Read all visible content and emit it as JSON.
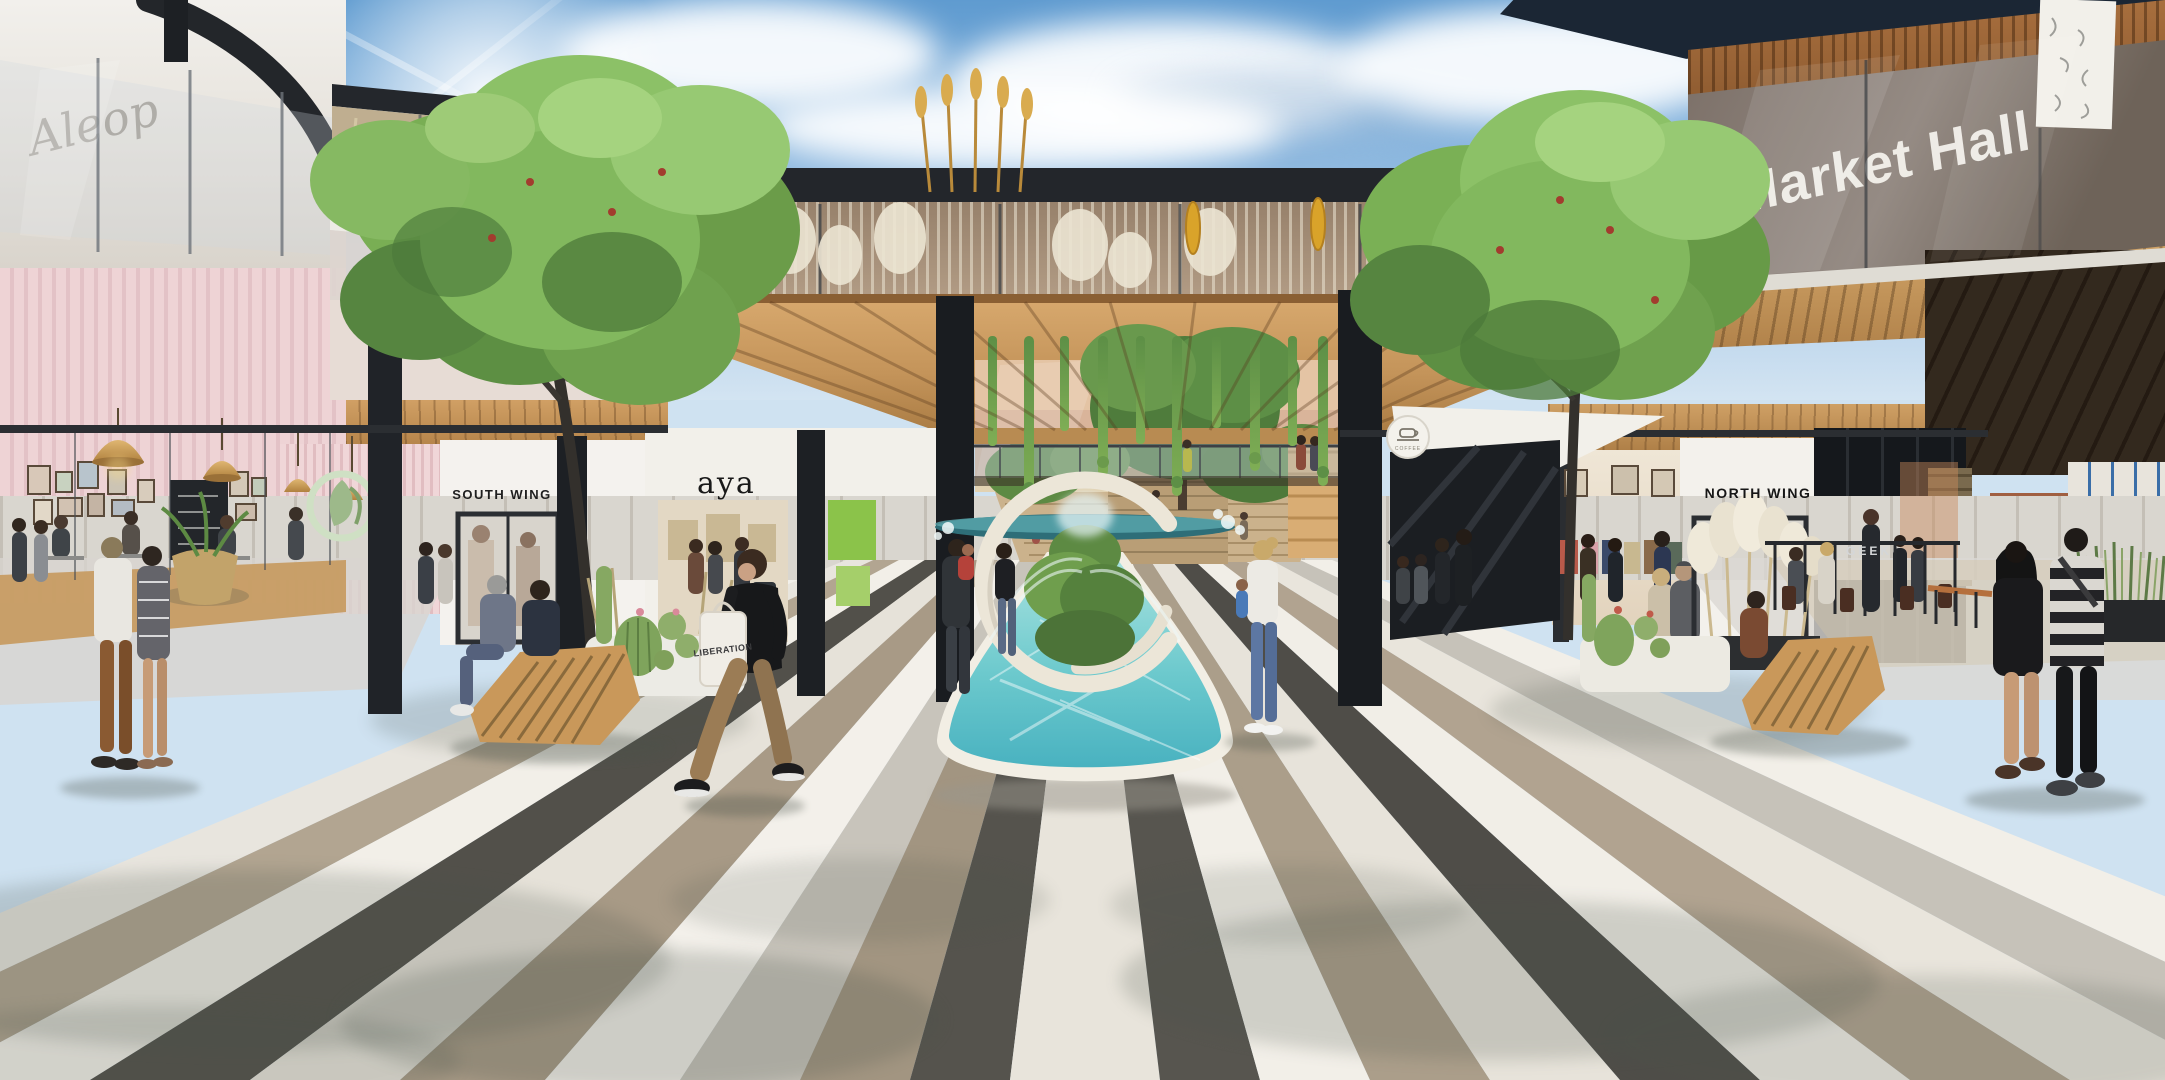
{
  "signs": {
    "aleop": "Aleop",
    "market_hall": "Market Hall",
    "south_wing": "SOUTH WING",
    "aya": "aya",
    "north_wing": "NORTH WING",
    "geek": "GEEK",
    "coffee_sign": "COFFEE",
    "tote_bag": "LIBERATION"
  },
  "icons": {
    "coffee_cup": "coffee-cup-icon",
    "leaf_logo": "leaf-logo-icon",
    "doodle_mural": "doodle-mural-banner"
  },
  "palette": {
    "sky_top": "#5f9bd0",
    "sky_horizon": "#d3e4f2",
    "cloud": "#f4f8fb",
    "wood_canopy": "#c9985f",
    "wood_dark": "#8a6236",
    "structure_dark": "#24272b",
    "glass": "#aebcc8",
    "water": "#59c4cc",
    "water_deep": "#2f9aa8",
    "basin_white": "#f3efe5",
    "pink_wall": "#eed3d5",
    "storefront_white": "#f4f2ee",
    "paving_white": "#f2efe8",
    "paving_taupe": "#a99b88",
    "paving_gray": "#c8c4bb",
    "paving_charcoal": "#4e4c47",
    "tree_green": "#6fa14c",
    "tree_green_dark": "#49713a",
    "grass_tan": "#cfc094",
    "pampas_white": "#ece5d3",
    "brick": "#9c5f43",
    "bench_wood": "#c9985a",
    "torch_flower": "#d9a32a"
  }
}
